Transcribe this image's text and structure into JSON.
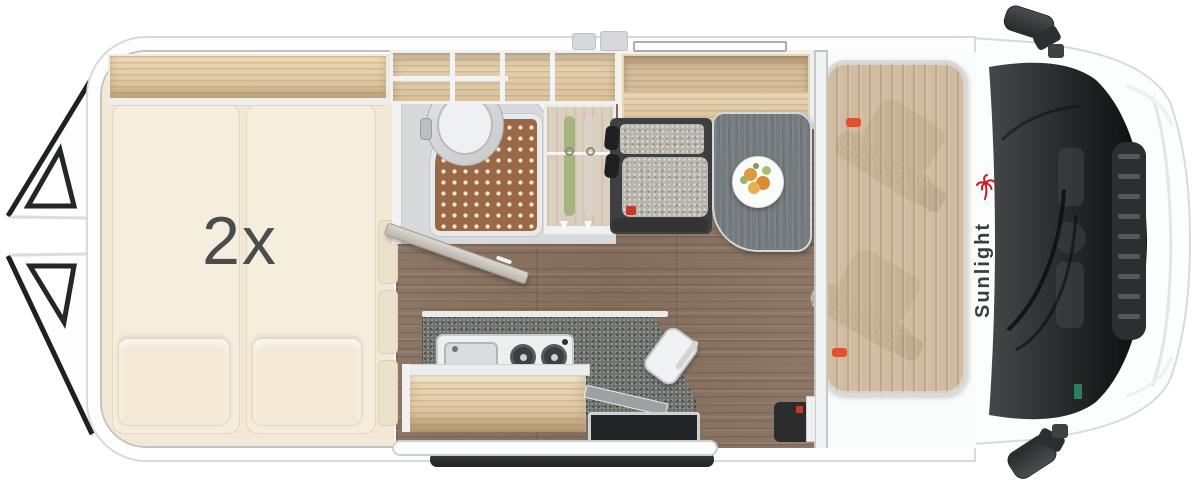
{
  "meta": {
    "description": "Top-down floor plan of a Sunlight camper van, front of vehicle on the right, rear doors open on the left"
  },
  "labels": {
    "bed_quantity": "2x",
    "brand": "Sunlight"
  },
  "colors": {
    "brand_red": "#cf1b24",
    "brand_text": "#3b3d3f",
    "body_white": "#fcfdfd",
    "bed_cream": "#f5ecda",
    "wood_shelf_oak": "#e3cfae",
    "wood_floor_brown": "#8a7261",
    "cab_wood_tan": "#c4ac8d",
    "kitchen_counter_gray": "#6e706c",
    "shower_mat_brown": "#996847",
    "bench_frame_dark": "#3e3f41",
    "cushion_speckle_gray": "#b8b4ab",
    "table_gray": "#747b7f",
    "windshield_dark": "#1b1c1e",
    "seatbelt_marker_red": "#e0512f"
  },
  "objects": [
    {
      "id": "rear-doors-open",
      "name": "Open rear barn doors"
    },
    {
      "id": "double-bed",
      "name": "Transverse double bed (2x)"
    },
    {
      "id": "overhead-shelf-bed",
      "name": "Overhead shelf above bed"
    },
    {
      "id": "bathroom",
      "name": "Wet bathroom with toilet, shower tray and corner sink"
    },
    {
      "id": "wardrobe",
      "name": "Wardrobe with hanging clothes"
    },
    {
      "id": "overhead-cabinet",
      "name": "Open overhead storage compartments"
    },
    {
      "id": "dinette-bench",
      "name": "Dinette bench seat with headrests"
    },
    {
      "id": "dinette-table",
      "name": "Dinette table with fruit plate"
    },
    {
      "id": "kitchen",
      "name": "Kitchen block with sink, two-burner hob and kettle"
    },
    {
      "id": "entry-step",
      "name": "Sliding-door entry step"
    },
    {
      "id": "cab-seats",
      "name": "Two swivelling cab seats under roof-bed panel"
    },
    {
      "id": "cab",
      "name": "Driver cab with windshield, hood and mirrors"
    }
  ]
}
